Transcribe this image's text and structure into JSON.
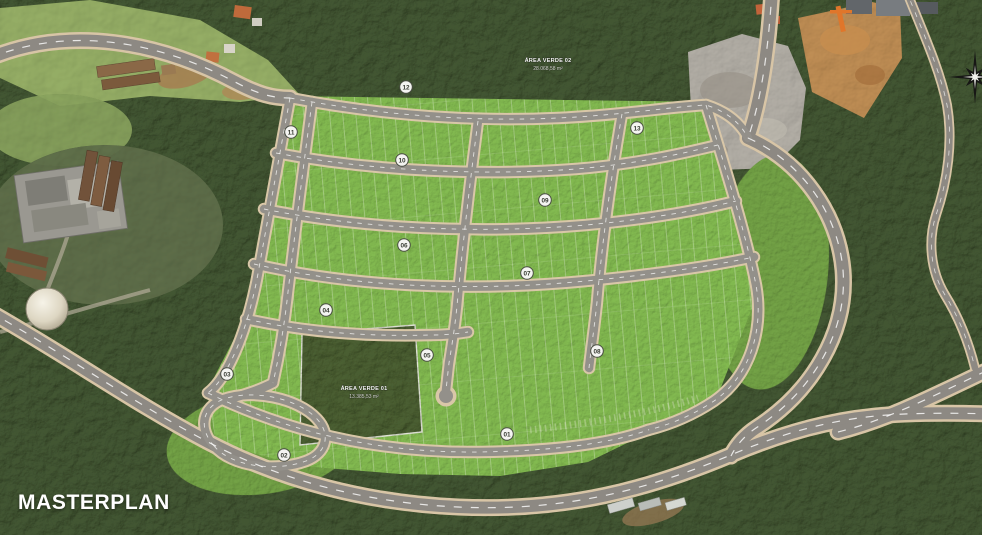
{
  "map": {
    "title_label": "MASTERPLAN",
    "green_areas": [
      {
        "name": "ÁREA VERDE 01",
        "area": "13.385,53 m²"
      },
      {
        "name": "ÁREA VERDE 02",
        "area": "28.068,58 m²"
      }
    ],
    "quadra_markers": [
      {
        "label": "01",
        "x": 507,
        "y": 434
      },
      {
        "label": "02",
        "x": 284,
        "y": 455
      },
      {
        "label": "03",
        "x": 227,
        "y": 374
      },
      {
        "label": "04",
        "x": 326,
        "y": 310
      },
      {
        "label": "05",
        "x": 427,
        "y": 355
      },
      {
        "label": "06",
        "x": 404,
        "y": 245
      },
      {
        "label": "07",
        "x": 527,
        "y": 273
      },
      {
        "label": "08",
        "x": 597,
        "y": 351
      },
      {
        "label": "09",
        "x": 545,
        "y": 200
      },
      {
        "label": "10",
        "x": 402,
        "y": 160
      },
      {
        "label": "11",
        "x": 291,
        "y": 132
      },
      {
        "label": "12",
        "x": 406,
        "y": 87
      },
      {
        "label": "13",
        "x": 637,
        "y": 128
      }
    ],
    "compass": {
      "icon": "compass-rose"
    },
    "colors": {
      "lot_green": "#66953e",
      "forest_green": "#2e3b24",
      "road_asphalt": "#8d8983",
      "road_casing": "#d8c5a6",
      "marker_bg": "#f4f4f1"
    }
  }
}
